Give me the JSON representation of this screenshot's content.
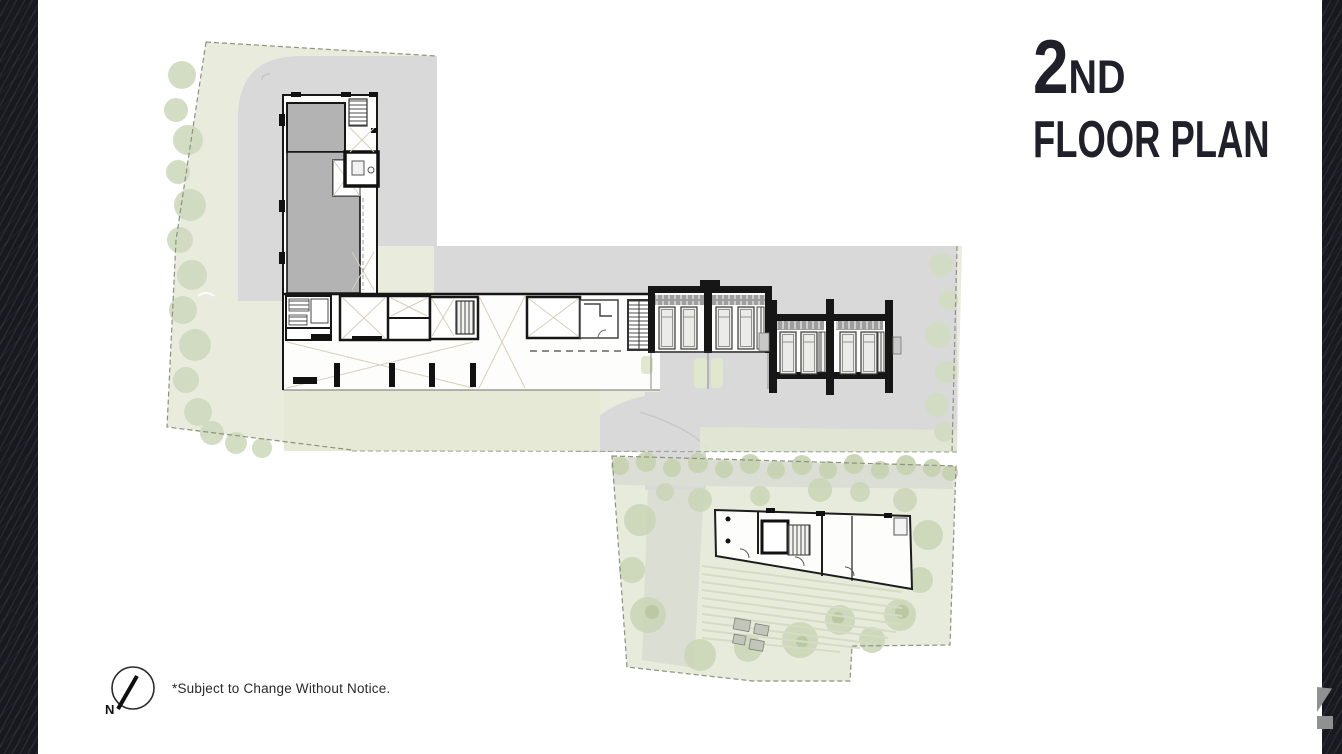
{
  "slide": {
    "title": {
      "number": "2",
      "suffix": "ND",
      "subtitle": "FLOOR PLAN"
    },
    "footnote": "*Subject to Change Without Notice.",
    "compass": {
      "label": "N"
    }
  },
  "colors": {
    "side_band_dark": "#18181f",
    "title_text": "#20202a",
    "site_green": "#e9ecdd",
    "landscape_tree_green": "#cdd8ba",
    "road_gray": "#d9d9d9",
    "tower_fill_gray": "#b3b3b3",
    "wall_black": "#161616",
    "unit_hatch_gray": "#9e9e9e",
    "logo_fragment_gray": "#8f9190"
  }
}
